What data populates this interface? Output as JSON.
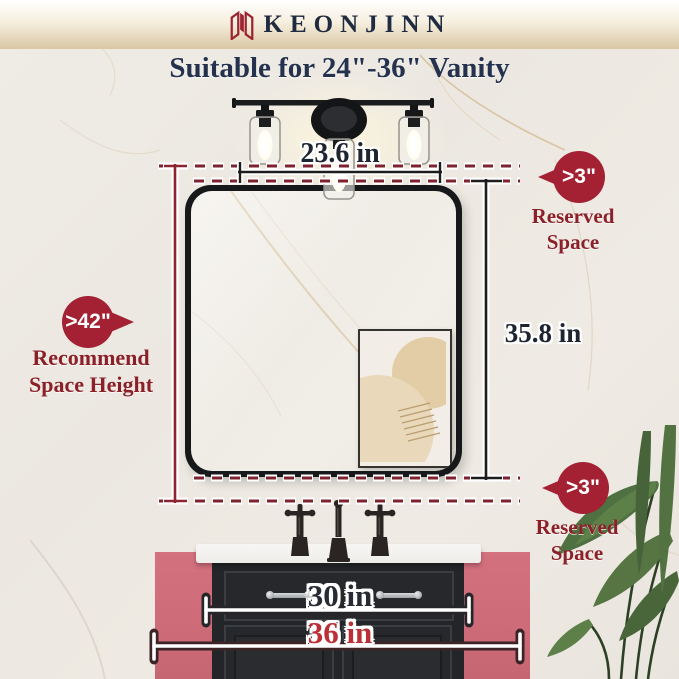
{
  "brand": {
    "name": "KEONJINN"
  },
  "title": "Suitable for 24\"-36\" Vanity",
  "measurements": {
    "fixture_width": "23.6 in",
    "mirror_height": "35.8 in",
    "vanity_width_min": "30 in",
    "vanity_width_max": "36 in"
  },
  "badges": {
    "left": {
      "value": ">42\"",
      "label_line1": "Recommend",
      "label_line2": "Space Height"
    },
    "top_right": {
      "value": ">3\"",
      "label_line1": "Reserved",
      "label_line2": "Space"
    },
    "bottom_right": {
      "value": ">3\"",
      "label_line1": "Reserved",
      "label_line2": "Space"
    }
  },
  "colors": {
    "badge_red": "#a32132",
    "label_red": "#8c2028",
    "dash_red": "#7e2230",
    "title_navy": "#24324e",
    "value_navy": "#272b33",
    "value_red": "#bb3036",
    "pink_wall": "#d4717e",
    "cabinet_dark": "#232528",
    "header_gold": "#d9c7a5"
  }
}
